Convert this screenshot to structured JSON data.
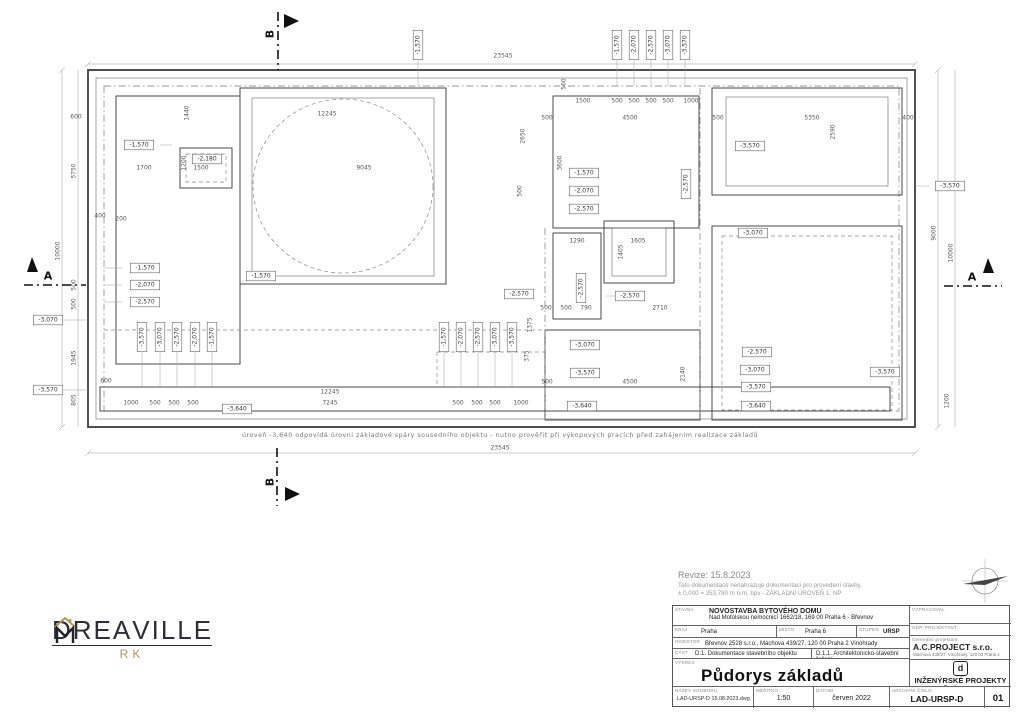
{
  "drawing": {
    "note": "úroveň -3,640 odpovídá úrovni základové spáry sousedního objektu - nutno prověřit při výkopových pracích před zahájením realizace základů",
    "section_a": "A",
    "section_b": "B",
    "elevation_labels": [
      {
        "t": "-1,570",
        "x": 139,
        "y": 145
      },
      {
        "t": "-2,180",
        "x": 207,
        "y": 159
      },
      {
        "t": "-1,570",
        "x": 261,
        "y": 276
      },
      {
        "t": "-2,570",
        "x": 519,
        "y": 294
      },
      {
        "t": "-1,570",
        "x": 584,
        "y": 173
      },
      {
        "t": "-2,070",
        "x": 584,
        "y": 191
      },
      {
        "t": "-2,570",
        "x": 584,
        "y": 209
      },
      {
        "t": "-1,570",
        "x": 145,
        "y": 268
      },
      {
        "t": "-2,070",
        "x": 145,
        "y": 285
      },
      {
        "t": "-2,570",
        "x": 145,
        "y": 302
      },
      {
        "t": "-3,070",
        "x": 48,
        "y": 320
      },
      {
        "t": "-3,570",
        "x": 48,
        "y": 390
      },
      {
        "t": "-3,570",
        "x": 750,
        "y": 146
      },
      {
        "t": "-3,570",
        "x": 950,
        "y": 186
      },
      {
        "t": "-3,070",
        "x": 753,
        "y": 233
      },
      {
        "t": "-2,570",
        "x": 630,
        "y": 296
      },
      {
        "t": "-3,070",
        "x": 585,
        "y": 345
      },
      {
        "t": "-3,570",
        "x": 585,
        "y": 373
      },
      {
        "t": "-3,640",
        "x": 582,
        "y": 406
      },
      {
        "t": "-2,570",
        "x": 757,
        "y": 352
      },
      {
        "t": "-3,070",
        "x": 755,
        "y": 370
      },
      {
        "t": "-3,570",
        "x": 756,
        "y": 387
      },
      {
        "t": "-3,640",
        "x": 756,
        "y": 406
      },
      {
        "t": "-3,570",
        "x": 885,
        "y": 372
      },
      {
        "t": "-3,640",
        "x": 237,
        "y": 409
      },
      {
        "t": "-1,570",
        "x": 418,
        "y": 45,
        "r": 1
      },
      {
        "t": "-1,570",
        "x": 617,
        "y": 45,
        "r": 1
      },
      {
        "t": "-2,070",
        "x": 634,
        "y": 45,
        "r": 1
      },
      {
        "t": "-2,570",
        "x": 651,
        "y": 45,
        "r": 1
      },
      {
        "t": "-3,070",
        "x": 668,
        "y": 45,
        "r": 1
      },
      {
        "t": "-3,570",
        "x": 685,
        "y": 45,
        "r": 1
      },
      {
        "t": "-1,570",
        "x": 444,
        "y": 337,
        "r": 1
      },
      {
        "t": "-2,070",
        "x": 461,
        "y": 337,
        "r": 1
      },
      {
        "t": "-2,570",
        "x": 478,
        "y": 337,
        "r": 1
      },
      {
        "t": "-3,070",
        "x": 495,
        "y": 337,
        "r": 1
      },
      {
        "t": "-3,570",
        "x": 512,
        "y": 337,
        "r": 1
      },
      {
        "t": "-3,570",
        "x": 142,
        "y": 337,
        "r": 1
      },
      {
        "t": "-3,070",
        "x": 160,
        "y": 337,
        "r": 1
      },
      {
        "t": "-2,570",
        "x": 177,
        "y": 337,
        "r": 1
      },
      {
        "t": "-2,070",
        "x": 195,
        "y": 337,
        "r": 1
      },
      {
        "t": "-1,570",
        "x": 212,
        "y": 337,
        "r": 1
      },
      {
        "t": "-2,570",
        "x": 686,
        "y": 184,
        "r": 1
      },
      {
        "t": "-2,570",
        "x": 581,
        "y": 288,
        "r": 1
      }
    ],
    "dimension_labels": [
      {
        "t": "23545",
        "x": 503,
        "y": 56
      },
      {
        "t": "23545",
        "x": 500,
        "y": 448
      },
      {
        "t": "12245",
        "x": 327,
        "y": 114
      },
      {
        "t": "9045",
        "x": 364,
        "y": 168
      },
      {
        "t": "1700",
        "x": 144,
        "y": 168
      },
      {
        "t": "1500",
        "x": 201,
        "y": 168
      },
      {
        "t": "600",
        "x": 76,
        "y": 117
      },
      {
        "t": "400",
        "x": 100,
        "y": 216
      },
      {
        "t": "200",
        "x": 121,
        "y": 219
      },
      {
        "t": "1440",
        "x": 187,
        "y": 113,
        "r": 1
      },
      {
        "t": "1200",
        "x": 184,
        "y": 163,
        "r": 1
      },
      {
        "t": "5750",
        "x": 74,
        "y": 171,
        "r": 1
      },
      {
        "t": "500",
        "x": 74,
        "y": 285,
        "r": 1
      },
      {
        "t": "500",
        "x": 74,
        "y": 304,
        "r": 1
      },
      {
        "t": "1945",
        "x": 74,
        "y": 358,
        "r": 1
      },
      {
        "t": "805",
        "x": 74,
        "y": 400,
        "r": 1
      },
      {
        "t": "10000",
        "x": 58,
        "y": 251,
        "r": 1
      },
      {
        "t": "1500",
        "x": 583,
        "y": 101
      },
      {
        "t": "500",
        "x": 617,
        "y": 101
      },
      {
        "t": "500",
        "x": 634,
        "y": 101
      },
      {
        "t": "500",
        "x": 651,
        "y": 101
      },
      {
        "t": "500",
        "x": 668,
        "y": 101
      },
      {
        "t": "1000",
        "x": 691,
        "y": 101
      },
      {
        "t": "500",
        "x": 547,
        "y": 118
      },
      {
        "t": "4500",
        "x": 630,
        "y": 118
      },
      {
        "t": "500",
        "x": 718,
        "y": 118
      },
      {
        "t": "5350",
        "x": 812,
        "y": 118
      },
      {
        "t": "400",
        "x": 908,
        "y": 118
      },
      {
        "t": "2590",
        "x": 833,
        "y": 132,
        "r": 1
      },
      {
        "t": "2650",
        "x": 523,
        "y": 136,
        "r": 1
      },
      {
        "t": "500",
        "x": 520,
        "y": 191,
        "r": 1
      },
      {
        "t": "3600",
        "x": 560,
        "y": 163,
        "r": 1
      },
      {
        "t": "560",
        "x": 564,
        "y": 84,
        "r": 1
      },
      {
        "t": "9000",
        "x": 934,
        "y": 233,
        "r": 1
      },
      {
        "t": "10000",
        "x": 951,
        "y": 253,
        "r": 1
      },
      {
        "t": "1200",
        "x": 947,
        "y": 401,
        "r": 1
      },
      {
        "t": "1290",
        "x": 577,
        "y": 241
      },
      {
        "t": "1605",
        "x": 638,
        "y": 241
      },
      {
        "t": "1405",
        "x": 621,
        "y": 252,
        "r": 1
      },
      {
        "t": "500",
        "x": 546,
        "y": 308
      },
      {
        "t": "500",
        "x": 566,
        "y": 308
      },
      {
        "t": "790",
        "x": 586,
        "y": 308
      },
      {
        "t": "2710",
        "x": 660,
        "y": 308
      },
      {
        "t": "1375",
        "x": 530,
        "y": 325,
        "r": 1
      },
      {
        "t": "375",
        "x": 527,
        "y": 356,
        "r": 1
      },
      {
        "t": "2140",
        "x": 683,
        "y": 374,
        "r": 1
      },
      {
        "t": "500",
        "x": 547,
        "y": 382
      },
      {
        "t": "4500",
        "x": 630,
        "y": 382
      },
      {
        "t": "12245",
        "x": 330,
        "y": 392
      },
      {
        "t": "7245",
        "x": 330,
        "y": 403
      },
      {
        "t": "500",
        "x": 458,
        "y": 403
      },
      {
        "t": "500",
        "x": 477,
        "y": 403
      },
      {
        "t": "500",
        "x": 495,
        "y": 403
      },
      {
        "t": "1000",
        "x": 521,
        "y": 403
      },
      {
        "t": "600",
        "x": 106,
        "y": 381
      },
      {
        "t": "1000",
        "x": 131,
        "y": 403
      },
      {
        "t": "500",
        "x": 155,
        "y": 403
      },
      {
        "t": "500",
        "x": 174,
        "y": 403
      },
      {
        "t": "500",
        "x": 193,
        "y": 403
      }
    ]
  },
  "logo": {
    "part1": "DREA",
    "part2": "VILLE",
    "sub": "RK"
  },
  "revision": {
    "revize": "Revize: 15.8.2023",
    "note1": "Tato dokumentace nenahrazuje dokumentaci pro provedení stavby.",
    "note2": "± 0,000 = 353,780 m n.m. bpv - ZÁKLADNÍ ÚROVEŇ 1. NP"
  },
  "title_block": {
    "stavba_label": "STAVBA",
    "stavba_value": "NOVOSTAVBA BYTOVÉHO DOMU",
    "stavba_address": "Nad Motolskou nemocnicí 1662/18, 169 00 Praha 6 - Břevnov",
    "kraj_label": "KRAJ",
    "kraj_value": "Praha",
    "misto_label": "MÍSTO",
    "misto_value": "Praha 6",
    "stupen_label": "STUPEŇ",
    "stupen_value": "URSP",
    "investor_label": "INVESTOR",
    "investor_value": "Břevnov 2528 s.r.o., Máchova 439/27, 120 00 Praha 2 Vinohrady",
    "cast_label": "ČÁST",
    "cast_value": "D.1. Dokumentace stavebního objektu",
    "cast_value2": "D.1.1. Architektonicko-stavební řešení",
    "vykres_label": "VÝKRES",
    "vykres_value": "Půdorys základů",
    "vypracoval_label": "VYPRACOVAL",
    "odp_projektant_label": "ODP. PROJEKTANT",
    "gen_projektant_label": "Generální projektant",
    "gen_projektant_name": "A.C.PROJECT s.r.o.",
    "gen_projektant_address": "Máchova 439/27, Vinohrady, 120 00 Praha 2",
    "eng_logo_letter": "d",
    "eng_name": "INŽENÝRSKÉ PROJEKTY",
    "eng_name2": "Praha s.r.o",
    "eng_address": "sídlo Moskevská 58, 101 00 PRAHA 10",
    "nazev_souboru_label": "NÁZEV SOUBORU",
    "nazev_souboru_value": "LAD-URSP-D 15.08.2023.dwg",
    "meritko_label": "MĚŘÍTKO",
    "meritko_value": "1:50",
    "datum_label": "DATUM",
    "datum_value": "červen 2022",
    "archivni_cislo_label": "ARCHIVNÍ ČÍSLO",
    "archivni_cislo_value": "LAD-URSP-D",
    "list_number": "01"
  }
}
